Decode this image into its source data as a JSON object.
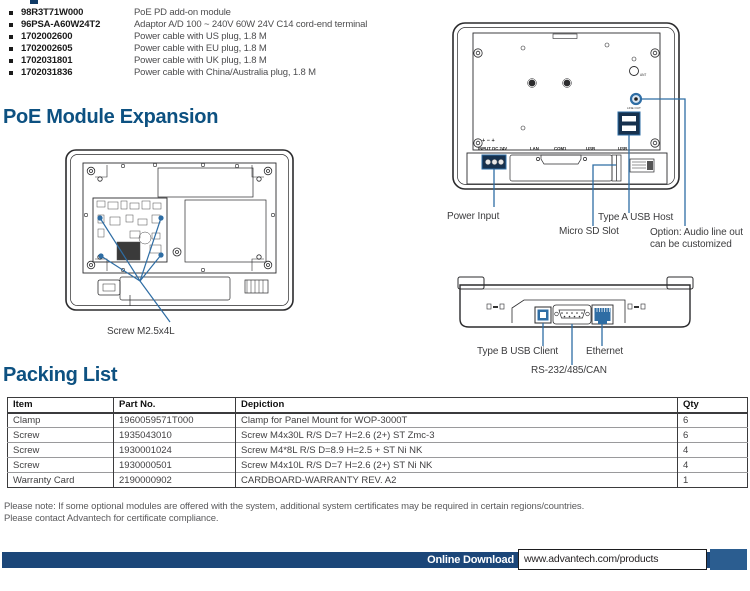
{
  "colors": {
    "accent_blue": "#2e6da4",
    "heading_blue": "#0d5181",
    "bar_navy": "#1b4679"
  },
  "accessories": [
    {
      "part": "98R3T71W000",
      "desc": "PoE PD add-on module"
    },
    {
      "part": "96PSA-A60W24T2",
      "desc": "Adaptor A/D 100 ~ 240V 60W 24V C14 cord-end terminal"
    },
    {
      "part": "1702002600",
      "desc": "Power cable with US plug, 1.8 M"
    },
    {
      "part": "1702002605",
      "desc": "Power cable with EU plug, 1.8 M"
    },
    {
      "part": "1702031801",
      "desc": "Power cable with UK plug, 1.8 M"
    },
    {
      "part": "1702031836",
      "desc": "Power cable with China/Australia plug, 1.8 M"
    }
  ],
  "poe_section": {
    "title": "PoE Module Expansion",
    "screw_callout": "Screw M2.5x4L"
  },
  "rear_diagram": {
    "ports": [
      "INPUT DC 24V",
      "LAN",
      "COM1",
      "USB",
      "USB"
    ],
    "polarity": "+ − +",
    "line_out": "LINE OUT",
    "ant": "ANT",
    "callouts": {
      "power": "Power Input",
      "micro_sd": "Micro SD Slot",
      "usb_host": "Type A USB Host",
      "option_1": "Option: Audio line out",
      "option_2": "can be customized"
    }
  },
  "bottom_diagram": {
    "callouts": {
      "usb_client": "Type B USB Client",
      "serial": "RS-232/485/CAN",
      "ethernet": "Ethernet"
    }
  },
  "packing_section": {
    "title": "Packing List",
    "headers": [
      "Item",
      "Part No.",
      "Depiction",
      "Qty"
    ],
    "rows": [
      {
        "item": "Clamp",
        "part_no": "1960059571T000",
        "depiction": "Clamp for Panel Mount for WOP-3000T",
        "qty": "6"
      },
      {
        "item": "Screw",
        "part_no": "1935043010",
        "depiction": "Screw M4x30L R/S D=7 H=2.6 (2+) ST Zmc-3",
        "qty": "6"
      },
      {
        "item": "Screw",
        "part_no": "1930001024",
        "depiction": "Screw M4*8L R/S D=8.9 H=2.5 + ST Ni NK",
        "qty": "4"
      },
      {
        "item": "Screw",
        "part_no": "1930000501",
        "depiction": "Screw M4x10L R/S D=7 H=2.6 (2+) ST Ni NK",
        "qty": "4"
      },
      {
        "item": "Warranty Card",
        "part_no": "2190000902",
        "depiction": "CARDBOARD-WARRANTY REV. A2",
        "qty": "1"
      }
    ]
  },
  "notes": {
    "line1": "Please note: If some optional modules are offered with the system, additional system certificates may be required in certain regions/countries.",
    "line2": "Please contact Advantech for certificate compliance."
  },
  "footer": {
    "label": "Online Download",
    "url": "www.advantech.com/products"
  }
}
